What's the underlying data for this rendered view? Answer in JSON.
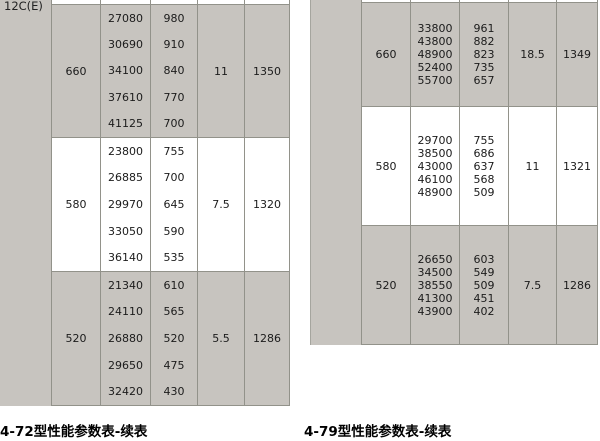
{
  "colors": {
    "section_shaded_bg": "#c7c4bf",
    "grid_border": "#92928a",
    "text": "#1b1b1b"
  },
  "left_table": {
    "corner_label": "12C(E)",
    "caption": "4-72型性能参数表-续表",
    "sections": [
      {
        "group": "660",
        "values_a": [
          "27080",
          "30690",
          "34100",
          "37610",
          "41125"
        ],
        "values_b": [
          "980",
          "910",
          "840",
          "770",
          "700"
        ],
        "value_c": "11",
        "value_d": "1350"
      },
      {
        "group": "580",
        "values_a": [
          "23800",
          "26885",
          "29970",
          "33050",
          "36140"
        ],
        "values_b": [
          "755",
          "700",
          "645",
          "590",
          "535"
        ],
        "value_c": "7.5",
        "value_d": "1320"
      },
      {
        "group": "520",
        "values_a": [
          "21340",
          "24110",
          "26880",
          "29650",
          "32420"
        ],
        "values_b": [
          "610",
          "565",
          "520",
          "475",
          "430"
        ],
        "value_c": "5.5",
        "value_d": "1286"
      }
    ]
  },
  "right_table": {
    "caption": "4-79型性能参数表-续表",
    "sections": [
      {
        "group": "660",
        "values_a": [
          "33800",
          "43800",
          "48900",
          "52400",
          "55700"
        ],
        "values_b": [
          "961",
          "882",
          "823",
          "735",
          "657"
        ],
        "value_c": "18.5",
        "value_d": "1349"
      },
      {
        "group": "580",
        "values_a": [
          "29700",
          "38500",
          "43000",
          "46100",
          "48900"
        ],
        "values_b": [
          "755",
          "686",
          "637",
          "568",
          "509"
        ],
        "value_c": "11",
        "value_d": "1321"
      },
      {
        "group": "520",
        "values_a": [
          "26650",
          "34500",
          "38550",
          "41300",
          "43900"
        ],
        "values_b": [
          "603",
          "549",
          "509",
          "451",
          "402"
        ],
        "value_c": "7.5",
        "value_d": "1286"
      }
    ]
  }
}
